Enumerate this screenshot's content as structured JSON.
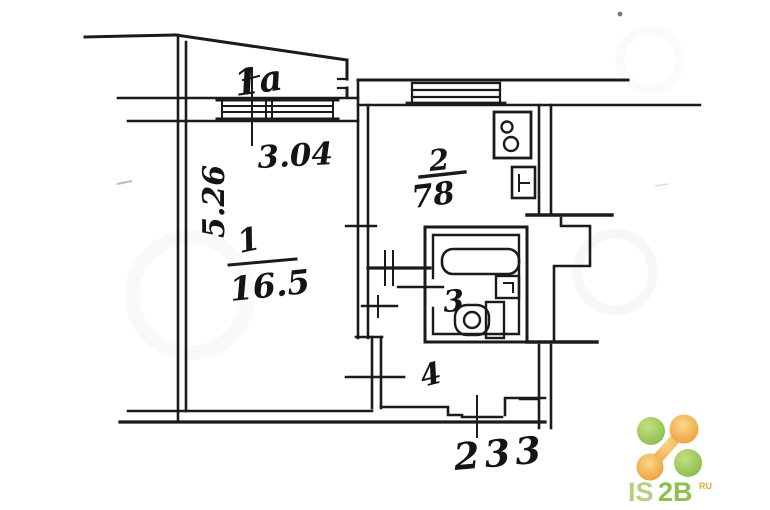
{
  "floorplan": {
    "balcony_label": "1a",
    "dim_top_width": "3.04",
    "dim_left_height": "5.26",
    "room1_number": "1",
    "room1_area": "16.5",
    "kitchen_number": "2",
    "kitchen_area": "78",
    "bathroom_number": "3",
    "hall_number": "4",
    "dim_bottom_width": "233"
  },
  "logo": {
    "part1": "IS",
    "part2": "2B",
    "superscript": "RU",
    "colors": {
      "green_light": "#b4cf85",
      "green": "#8dbf4a",
      "orange": "#efa13d",
      "ink": "#1b1b1b"
    }
  }
}
